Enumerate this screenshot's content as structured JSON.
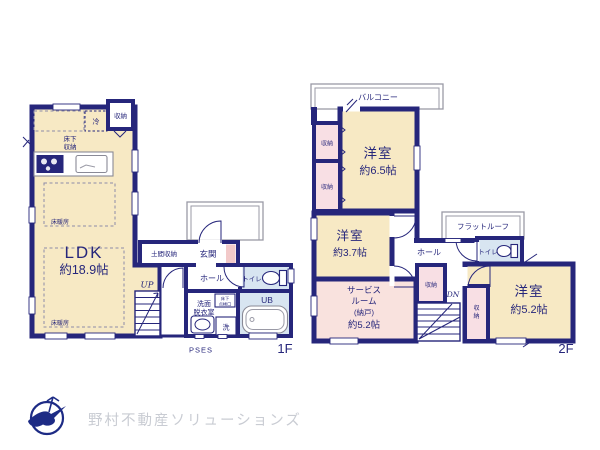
{
  "meta": {
    "kind": "floor-plan",
    "floors": [
      "1F",
      "2F"
    ]
  },
  "colors": {
    "wall_navy": "#26267b",
    "room_cream": "#f7e9c4",
    "closet_pink": "#f8dfe4",
    "service_pink": "#f9e2de",
    "wet_blue": "#d8e5f1",
    "genkan_accent_pink": "#f2c9c9",
    "outline_gray": "#9a9aa6",
    "logo_navy": "#1d2b85",
    "logo_text_gray": "#c9ccd3"
  },
  "floor1": {
    "floor_label": "1F",
    "ldk": {
      "name": "LDK",
      "size": "約18.9帖"
    },
    "labels": {
      "fridge": "冷",
      "storage_top": "収納",
      "underfloor_storage_1": "床下",
      "underfloor_storage_2": "収納",
      "floor_heating_upper": "床暖房",
      "floor_heating_lower": "床暖房",
      "doma_storage": "土間収納",
      "genkan": "玄関",
      "hall": "ホール",
      "toilet": "トイレ",
      "washroom_1": "洗面",
      "washroom_2": "脱衣室",
      "inspection_hatch_1": "床下",
      "inspection_hatch_2": "点検口",
      "unit_bath": "UB",
      "laundry": "洗",
      "stairs_up": "UP",
      "pses": "PSES"
    }
  },
  "floor2": {
    "floor_label": "2F",
    "rooms": {
      "yoshitsu_65": {
        "name": "洋室",
        "size": "約6.5帖"
      },
      "yoshitsu_37": {
        "name": "洋室",
        "size": "約3.7帖"
      },
      "yoshitsu_52": {
        "name": "洋室",
        "size": "約5.2帖"
      },
      "service_room": {
        "line1": "サービス",
        "line2": "ルーム",
        "line3": "(納戸)",
        "size": "約5.2帖"
      }
    },
    "labels": {
      "balcony": "バルコニー",
      "closet_a": "収納",
      "closet_b": "収納",
      "closet_center": "収納",
      "closet_right_1": "収",
      "closet_right_2": "納",
      "flat_roof": "フラットルーフ",
      "hall": "ホール",
      "toilet": "トイレ",
      "stairs_down": "DN"
    }
  },
  "footer": {
    "company": "野村不動産ソリューションズ"
  }
}
